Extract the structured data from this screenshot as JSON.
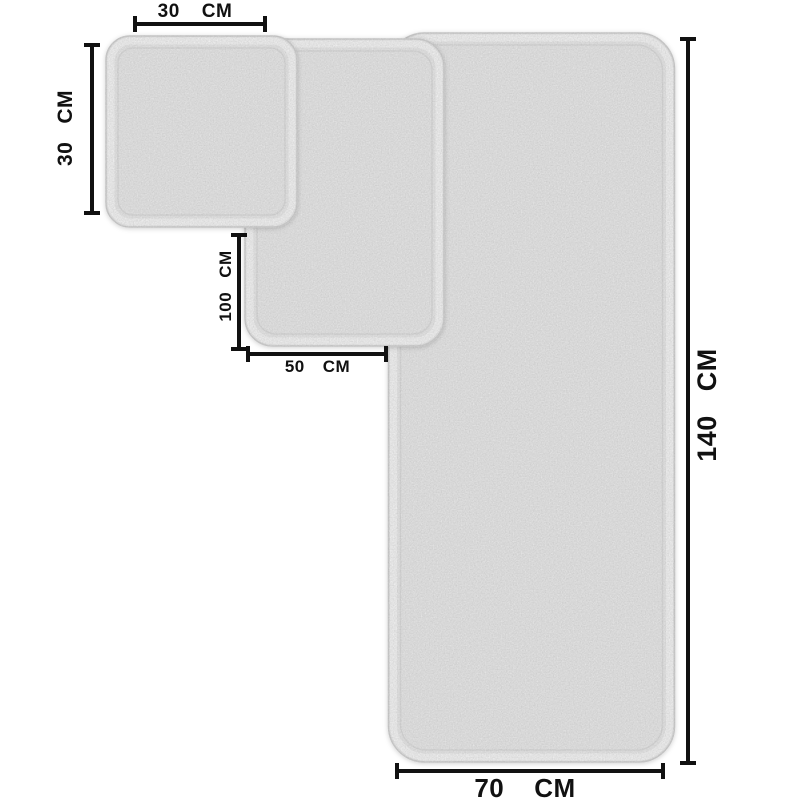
{
  "diagram": {
    "unit": "CM",
    "towels": [
      {
        "id": "small",
        "width": "30",
        "height": "30",
        "unit": "CM"
      },
      {
        "id": "medium",
        "width": "50",
        "height": "100",
        "unit": "CM"
      },
      {
        "id": "large",
        "width": "70",
        "height": "140",
        "unit": "CM"
      }
    ],
    "dimensions": {
      "top_width": {
        "value": "30",
        "unit": "CM"
      },
      "left_height": {
        "value": "30",
        "unit": "CM"
      },
      "mid_height": {
        "value": "100",
        "unit": "CM"
      },
      "mid_width": {
        "value": "50",
        "unit": "CM"
      },
      "right_height": {
        "value": "140",
        "unit": "CM"
      },
      "bottom_width": {
        "value": "70",
        "unit": "CM"
      }
    },
    "colors": {
      "line": "#111111",
      "towel_fill": "#f2f2f2",
      "towel_edge": "#d8d8d8",
      "background": "#ffffff"
    }
  }
}
